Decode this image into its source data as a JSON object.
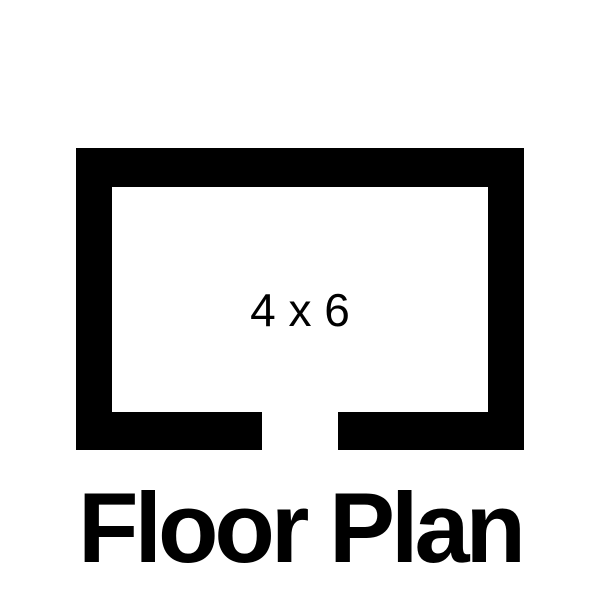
{
  "colors": {
    "ink": "#000000",
    "bg": "#ffffff"
  },
  "icon": {
    "name": "floor-plan-outline",
    "room_label": "4 x 6",
    "door_opening": "bottom-center"
  },
  "title": {
    "text": "Floor Plan"
  }
}
